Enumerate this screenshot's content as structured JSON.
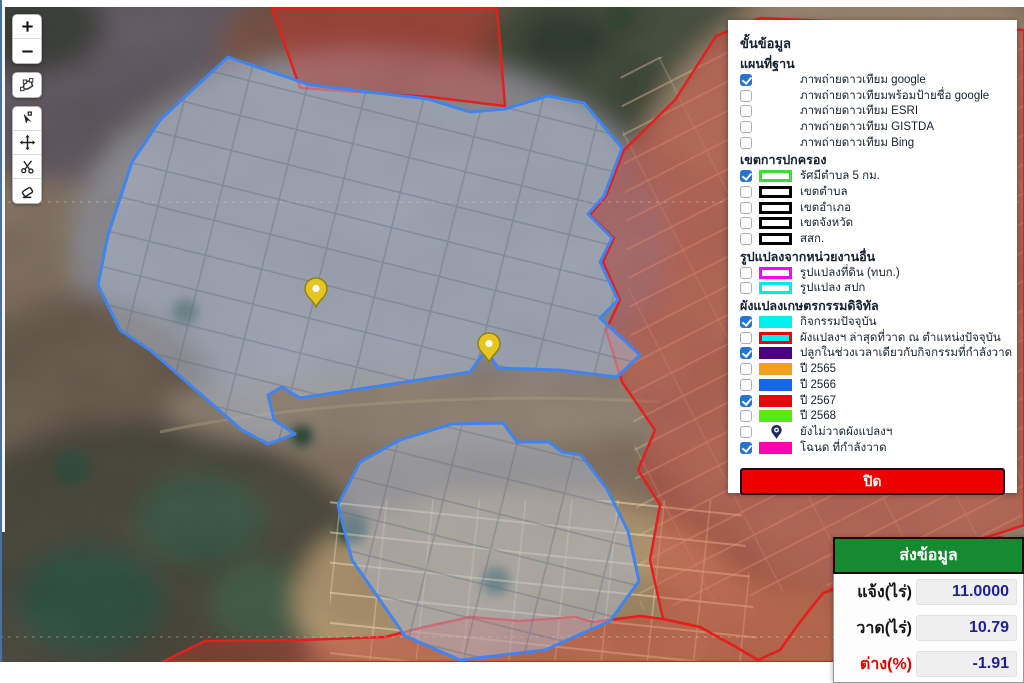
{
  "map": {
    "pins": [
      {
        "name": "map-pin-1",
        "x": 316,
        "y": 307
      },
      {
        "name": "map-pin-2",
        "x": 489,
        "y": 362
      }
    ],
    "colors": {
      "drawn_parcel_outline": "#3f84f0",
      "drawn_parcel_fill": "rgba(173,188,210,0.5)",
      "year2567_parcel_outline": "#e51f1f",
      "year2567_parcel_fill": "rgba(224,45,35,0.33)",
      "pin_fill": "#e5c51f"
    }
  },
  "toolbar": {
    "buttons": [
      {
        "name": "zoom-in-button",
        "icon": "plus-icon",
        "group": 1
      },
      {
        "name": "zoom-out-button",
        "icon": "minus-icon",
        "group": 1
      },
      {
        "name": "draw-polygon-button",
        "icon": "polygon-icon",
        "group": 2
      },
      {
        "name": "edit-vertex-button",
        "icon": "edit-vertex-icon",
        "group": 3
      },
      {
        "name": "move-feature-button",
        "icon": "move-icon",
        "group": 3
      },
      {
        "name": "cut-feature-button",
        "icon": "scissors-icon",
        "group": 3
      },
      {
        "name": "erase-feature-button",
        "icon": "eraser-icon",
        "group": 3
      }
    ]
  },
  "layers_panel": {
    "title": "ขั้นข้อมูล",
    "close_label": "ปิด",
    "sections": [
      {
        "heading": "แผนที่ฐาน",
        "items": [
          {
            "label": "ภาพถ่ายดาวเทียม google",
            "checked": true,
            "swatch": {
              "type": "none"
            }
          },
          {
            "label": "ภาพถ่ายดาวเทียมพร้อมป้ายชื่อ google",
            "checked": false,
            "swatch": {
              "type": "none"
            }
          },
          {
            "label": "ภาพถ่ายดาวเทียม ESRI",
            "checked": false,
            "swatch": {
              "type": "none"
            }
          },
          {
            "label": "ภาพถ่ายดาวเทียม GISTDA",
            "checked": false,
            "swatch": {
              "type": "none"
            }
          },
          {
            "label": "ภาพถ่ายดาวเทียม Bing",
            "checked": false,
            "swatch": {
              "type": "none"
            }
          }
        ]
      },
      {
        "heading": "เขตการปกครอง",
        "items": [
          {
            "label": "รัศมีตำบล 5 กม.",
            "checked": true,
            "swatch": {
              "type": "outline",
              "color": "#3bdb3b"
            }
          },
          {
            "label": "เขตตำบล",
            "checked": false,
            "swatch": {
              "type": "outline",
              "color": "#000000"
            }
          },
          {
            "label": "เขตอำเภอ",
            "checked": false,
            "swatch": {
              "type": "outline",
              "color": "#000000"
            }
          },
          {
            "label": "เขตจังหวัด",
            "checked": false,
            "swatch": {
              "type": "outline",
              "color": "#000000"
            }
          },
          {
            "label": "สสก.",
            "checked": false,
            "swatch": {
              "type": "outline",
              "color": "#000000"
            }
          }
        ]
      },
      {
        "heading": "รูปแปลงจากหน่วยงานอื่น",
        "items": [
          {
            "label": "รูปแปลงที่ดิน (ทบก.)",
            "checked": false,
            "swatch": {
              "type": "outline",
              "color": "#ff00ff"
            }
          },
          {
            "label": "รูปแปลง สปก",
            "checked": false,
            "swatch": {
              "type": "outline",
              "color": "#00e8e8"
            }
          }
        ]
      },
      {
        "heading": "ผังแปลงเกษตรกรรมดิจิทัล",
        "items": [
          {
            "label": "กิจกรรมปัจจุบัน",
            "checked": true,
            "swatch": {
              "type": "fill",
              "color": "#00efef"
            }
          },
          {
            "label": "ผังแปลงฯ ล่าสุดที่วาด ณ ตำแหน่งปัจจุบัน",
            "checked": false,
            "swatch": {
              "type": "fill",
              "color": "#00efef",
              "border": "#ee0000"
            }
          },
          {
            "label": "ปลูกในช่วงเวลาเดียวกับกิจกรรมที่กำลังวาด",
            "checked": true,
            "swatch": {
              "type": "fill",
              "color": "#4b0082"
            }
          },
          {
            "label": "ปี 2565",
            "checked": false,
            "swatch": {
              "type": "fill",
              "color": "#f2a11c"
            }
          },
          {
            "label": "ปี 2566",
            "checked": false,
            "swatch": {
              "type": "fill",
              "color": "#1566ef"
            }
          },
          {
            "label": "ปี 2567",
            "checked": true,
            "swatch": {
              "type": "fill",
              "color": "#ee0404"
            }
          },
          {
            "label": "ปี 2568",
            "checked": false,
            "swatch": {
              "type": "fill",
              "color": "#58e813"
            }
          },
          {
            "label": "ยังไม่วาดผังแปลงฯ",
            "checked": false,
            "swatch": {
              "type": "pin",
              "color": "#1c2b5e"
            }
          },
          {
            "label": "โฉนด ที่กำลังวาด",
            "checked": true,
            "swatch": {
              "type": "fill",
              "color": "#ff00b0"
            }
          }
        ]
      }
    ]
  },
  "summary_table": {
    "header": "ส่งข้อมูล",
    "header_color": "#168a2e",
    "rows": [
      {
        "label": "แจ้ง(ไร่)",
        "value": "11.0000",
        "label_color": "black"
      },
      {
        "label": "วาด(ไร่)",
        "value": "10.79",
        "label_color": "black"
      },
      {
        "label": "ต่าง(%)",
        "value": "-1.91",
        "label_color": "red"
      }
    ]
  }
}
